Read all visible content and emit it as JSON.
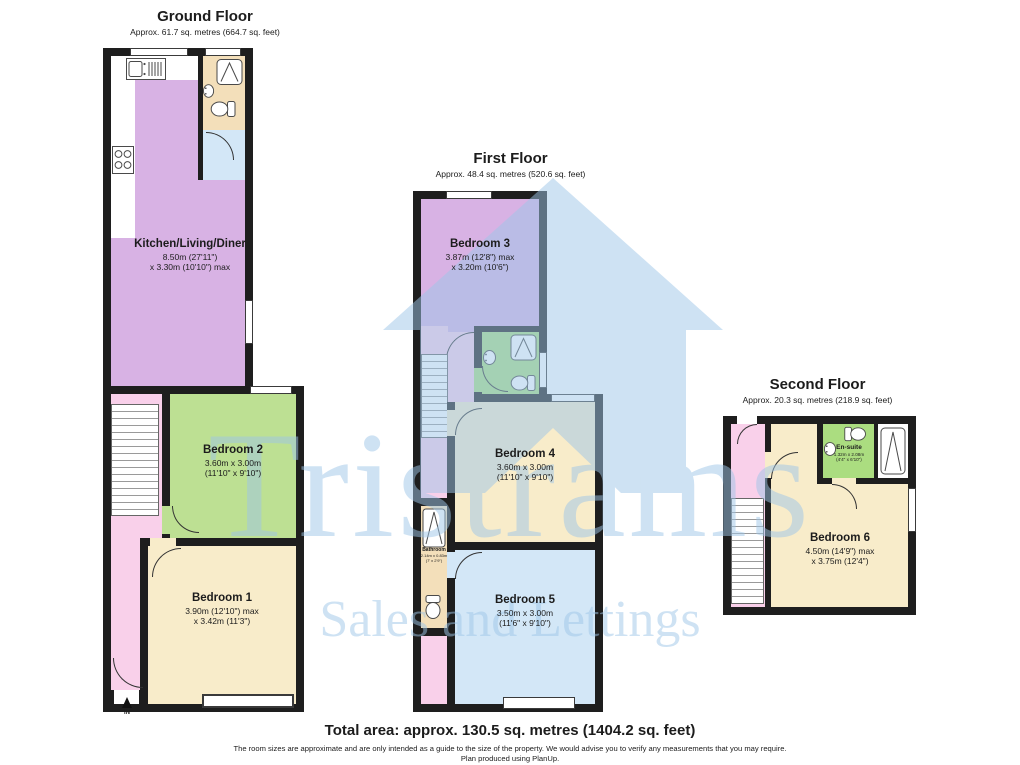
{
  "watermark": {
    "brand": "Tristrams",
    "tagline": "Sales and Lettings"
  },
  "floors": {
    "ground": {
      "title": "Ground Floor",
      "subtitle": "Approx. 61.7 sq. metres (664.7 sq. feet)"
    },
    "first": {
      "title": "First Floor",
      "subtitle": "Approx. 48.4 sq. metres (520.6 sq. feet)"
    },
    "second": {
      "title": "Second Floor",
      "subtitle": "Approx. 20.3 sq. metres (218.9 sq. feet)"
    }
  },
  "rooms": {
    "kitchen": {
      "name": "Kitchen/Living/Diner",
      "dim1": "8.50m (27'11\")",
      "dim2": "x 3.30m (10'10\") max"
    },
    "bedroom1": {
      "name": "Bedroom 1",
      "dim1": "3.90m (12'10\") max",
      "dim2": "x 3.42m (11'3\")"
    },
    "bedroom2": {
      "name": "Bedroom 2",
      "dim1": "3.60m x 3.00m",
      "dim2": "(11'10\" x 9'10\")"
    },
    "bedroom3": {
      "name": "Bedroom 3",
      "dim1": "3.87m (12'8\") max",
      "dim2": "x 3.20m (10'6\")"
    },
    "bedroom4": {
      "name": "Bedroom 4",
      "dim1": "3.60m x 3.00m",
      "dim2": "(11'10\" x 9'10\")"
    },
    "bedroom5": {
      "name": "Bedroom 5",
      "dim1": "3.50m x 3.00m",
      "dim2": "(11'6\" x 9'10\")"
    },
    "bedroom6": {
      "name": "Bedroom 6",
      "dim1": "4.50m (14'9\") max",
      "dim2": "x 3.75m (12'4\")"
    },
    "bathroom": {
      "name": "Bathroom",
      "dim1": "2.14m x 0.83m",
      "dim2": "(7' x 2'9\")"
    },
    "ensuite": {
      "name": "En-suite",
      "dim1": "1.32m x 2.08m",
      "dim2": "(4'4\" x 6'10\")"
    }
  },
  "entrance": {
    "label": "IN"
  },
  "footer": {
    "total": "Total area: approx. 130.5 sq. metres (1404.2 sq. feet)",
    "disclaimer": "The room sizes are approximate and are only intended as a guide to the size of the property. We would advise you to verify any measurements that you may require.",
    "credit": "Plan produced using PlanUp."
  },
  "colors": {
    "wall": "#1e1e1e",
    "purple": "#d8b2e4",
    "green_bedroom": "#bde093",
    "green_bath": "#abdd80",
    "cream": "#f8ecca",
    "tan": "#f3dfba",
    "blue": "#d3e7f7",
    "pink": "#f9d0ea",
    "watermark_blue": "#c8def0"
  }
}
